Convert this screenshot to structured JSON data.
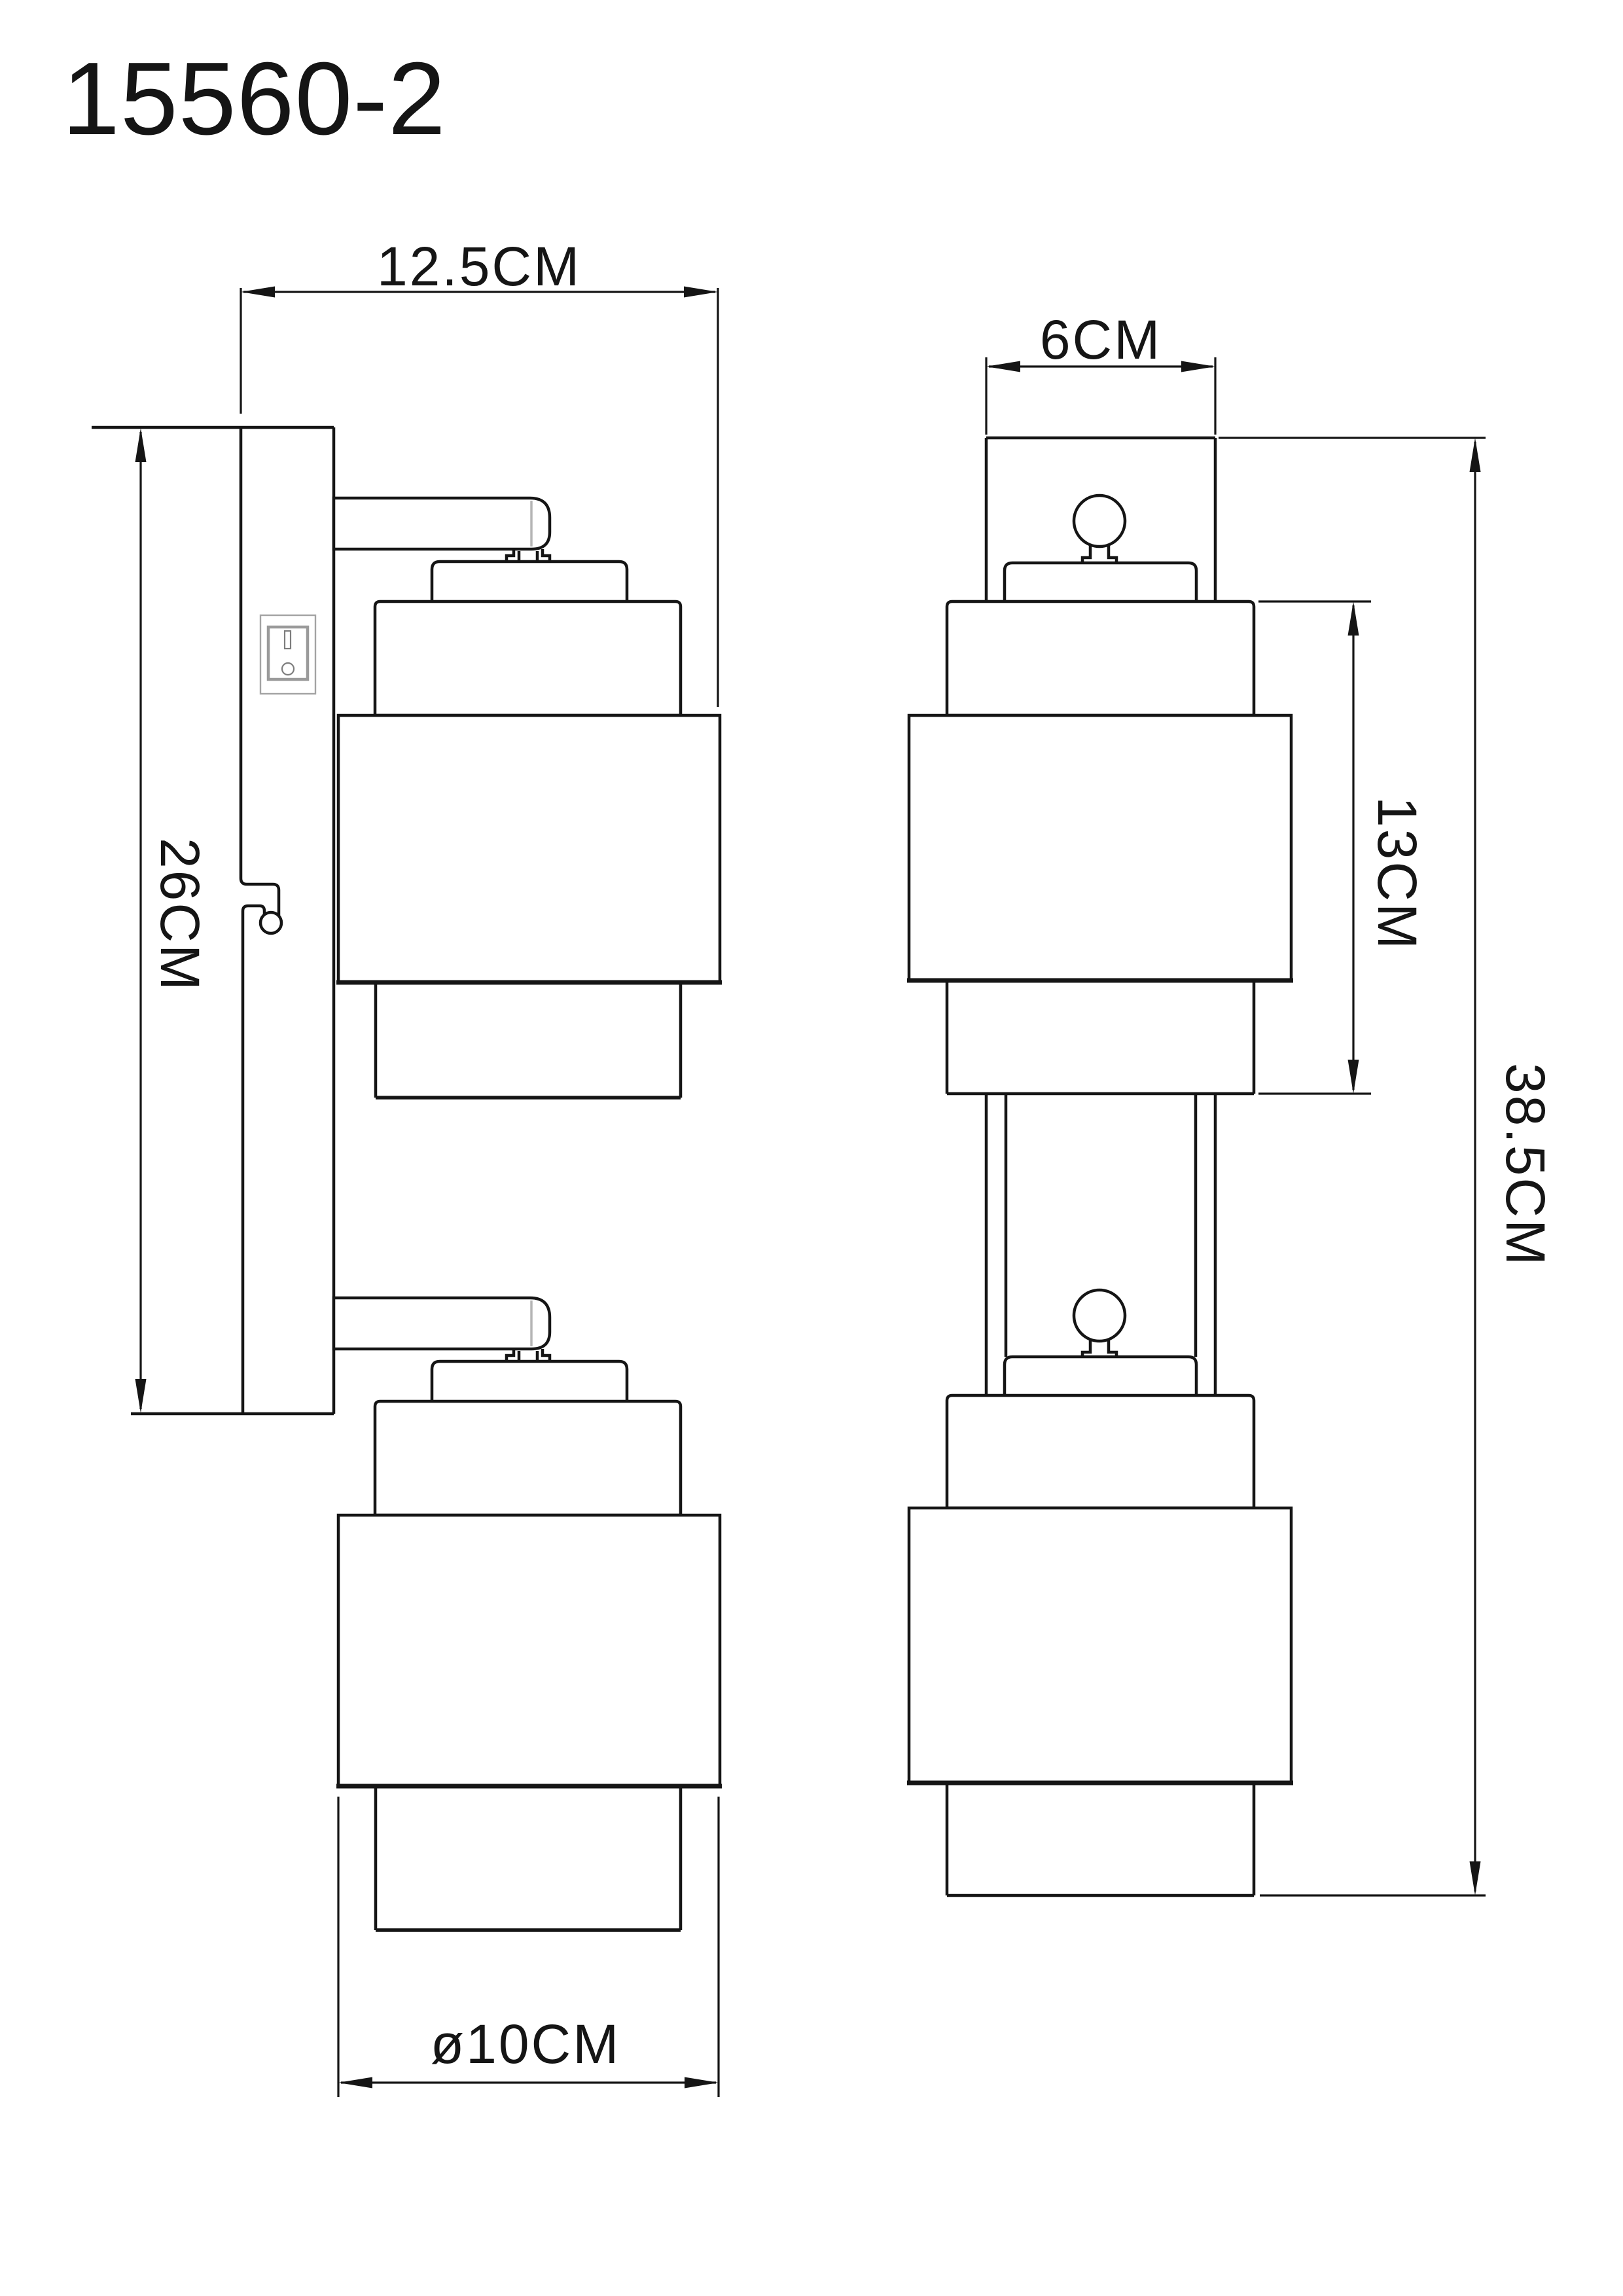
{
  "page": {
    "background_color": "#ffffff",
    "line_color": "#151515",
    "seam_color": "#b5b5b5"
  },
  "title": "15560-2",
  "views": {
    "side_view": {
      "name": "side view with wall plate, switch and two spot shades",
      "dimensions": {
        "plate_depth": "12.5CM",
        "plate_height": "26CM",
        "shade_diameter": "ø10CM"
      }
    },
    "front_view": {
      "name": "front view with two stacked shades and bulbs",
      "dimensions": {
        "plate_width": "6CM",
        "head_height": "13CM",
        "total_height": "38.5CM"
      }
    }
  }
}
